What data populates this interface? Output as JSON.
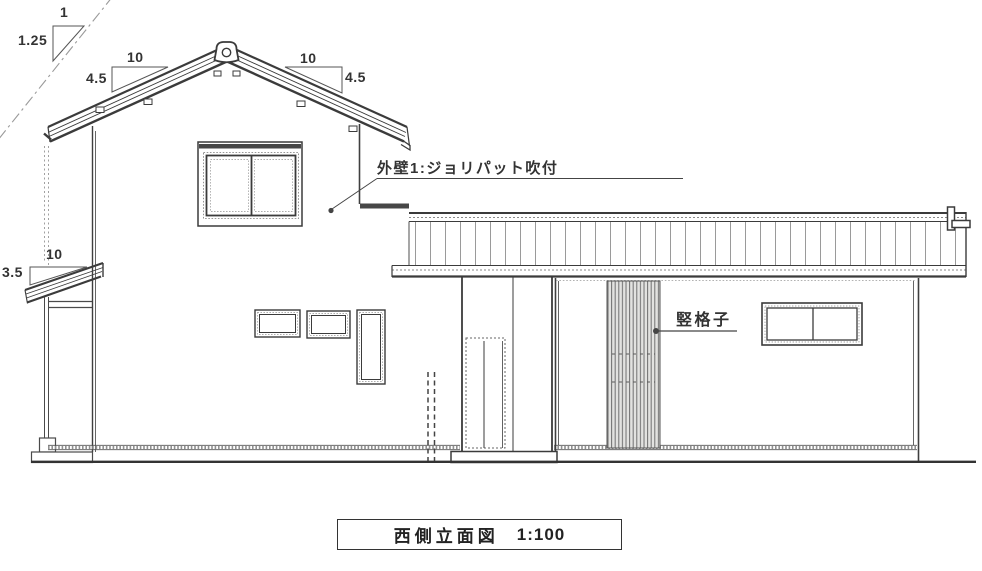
{
  "drawing_type": "architectural-elevation",
  "palette": {
    "ink": "#3b3b3b",
    "faint_line": "#8a8a8a",
    "lattice_fill": "#e2e2e0",
    "paper": "#ffffff"
  },
  "titleblock": {
    "title": "西側立面図",
    "scale": "1:100"
  },
  "annotations": {
    "wall_finish": "外壁1:ジョリパット吹付",
    "lattice": "竪格子"
  },
  "slope_indicators": {
    "setback": {
      "run": "1",
      "rise": "1.25"
    },
    "roof_left": {
      "run": "10",
      "rise": "4.5"
    },
    "roof_right": {
      "run": "10",
      "rise": "4.5"
    },
    "pent": {
      "run": "10",
      "rise": "3.5"
    }
  }
}
